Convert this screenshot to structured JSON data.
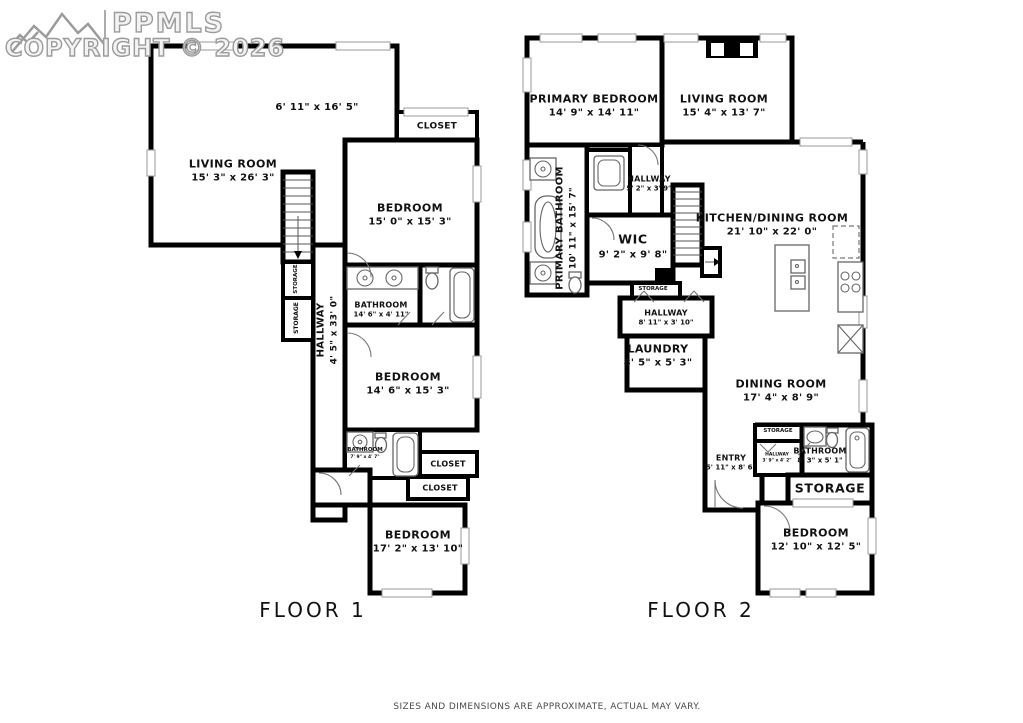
{
  "header": {
    "logo": "PPMLS",
    "logo_icon": "mountains-icon",
    "copyright": "COPYRIGHT © 2026"
  },
  "floor1": {
    "label": "FLOOR 1",
    "rooms": [
      {
        "name": "LIVING ROOM",
        "dims": "15' 3\" x 26' 3\""
      },
      {
        "name": "",
        "dims": "6' 11\" x 16' 5\""
      },
      {
        "name": "CLOSET",
        "dims": ""
      },
      {
        "name": "BEDROOM",
        "dims": "15' 0\" x 15' 3\""
      },
      {
        "name": "STORAGE",
        "dims": ""
      },
      {
        "name": "STORAGE",
        "dims": ""
      },
      {
        "name": "HALLWAY",
        "dims": "4' 5\" x 33' 0\""
      },
      {
        "name": "BATHROOM",
        "dims": "14' 6\" x 4' 11\""
      },
      {
        "name": "BEDROOM",
        "dims": "14' 6\" x 15' 3\""
      },
      {
        "name": "BATHROOM",
        "dims": "7' 9\" x 4' 7\""
      },
      {
        "name": "CLOSET",
        "dims": ""
      },
      {
        "name": "CLOSET",
        "dims": ""
      },
      {
        "name": "BEDROOM",
        "dims": "17' 2\" x 13' 10\""
      }
    ]
  },
  "floor2": {
    "label": "FLOOR 2",
    "rooms": [
      {
        "name": "PRIMARY BEDROOM",
        "dims": "14' 9\" x 14' 11\""
      },
      {
        "name": "LIVING ROOM",
        "dims": "15' 4\" x 13' 7\""
      },
      {
        "name": "HALLWAY",
        "dims": "5' 2\" x 3' 9\""
      },
      {
        "name": "PRIMARY BATHROOM",
        "dims": "10' 11\" x 15' 7\""
      },
      {
        "name": "WIC",
        "dims": "9' 2\" x 9' 8\""
      },
      {
        "name": "KITCHEN/DINING ROOM",
        "dims": "21' 10\" x 22' 0\""
      },
      {
        "name": "STORAGE",
        "dims": ""
      },
      {
        "name": "HALLWAY",
        "dims": "8' 11\" x 3' 10\""
      },
      {
        "name": "LAUNDRY",
        "dims": "8' 5\" x 5' 3\""
      },
      {
        "name": "DINING ROOM",
        "dims": "17' 4\" x 8' 9\""
      },
      {
        "name": "ENTRY",
        "dims": "5' 11\" x 8' 6\""
      },
      {
        "name": "STORAGE",
        "dims": ""
      },
      {
        "name": "HALLWAY",
        "dims": "3' 9\" x 4' 2\""
      },
      {
        "name": "BATHROOM",
        "dims": "8' 3\" x 5' 1\""
      },
      {
        "name": "STORAGE",
        "dims": ""
      },
      {
        "name": "BEDROOM",
        "dims": "12' 10\" x 12' 5\""
      }
    ]
  },
  "footer": {
    "disclaimer": "SIZES AND DIMENSIONS ARE APPROXIMATE, ACTUAL MAY VARY."
  },
  "colors": {
    "walls": "#000000",
    "logo": "#9b9b9b",
    "text": "#111111",
    "footer_text": "#4a4a4a"
  }
}
